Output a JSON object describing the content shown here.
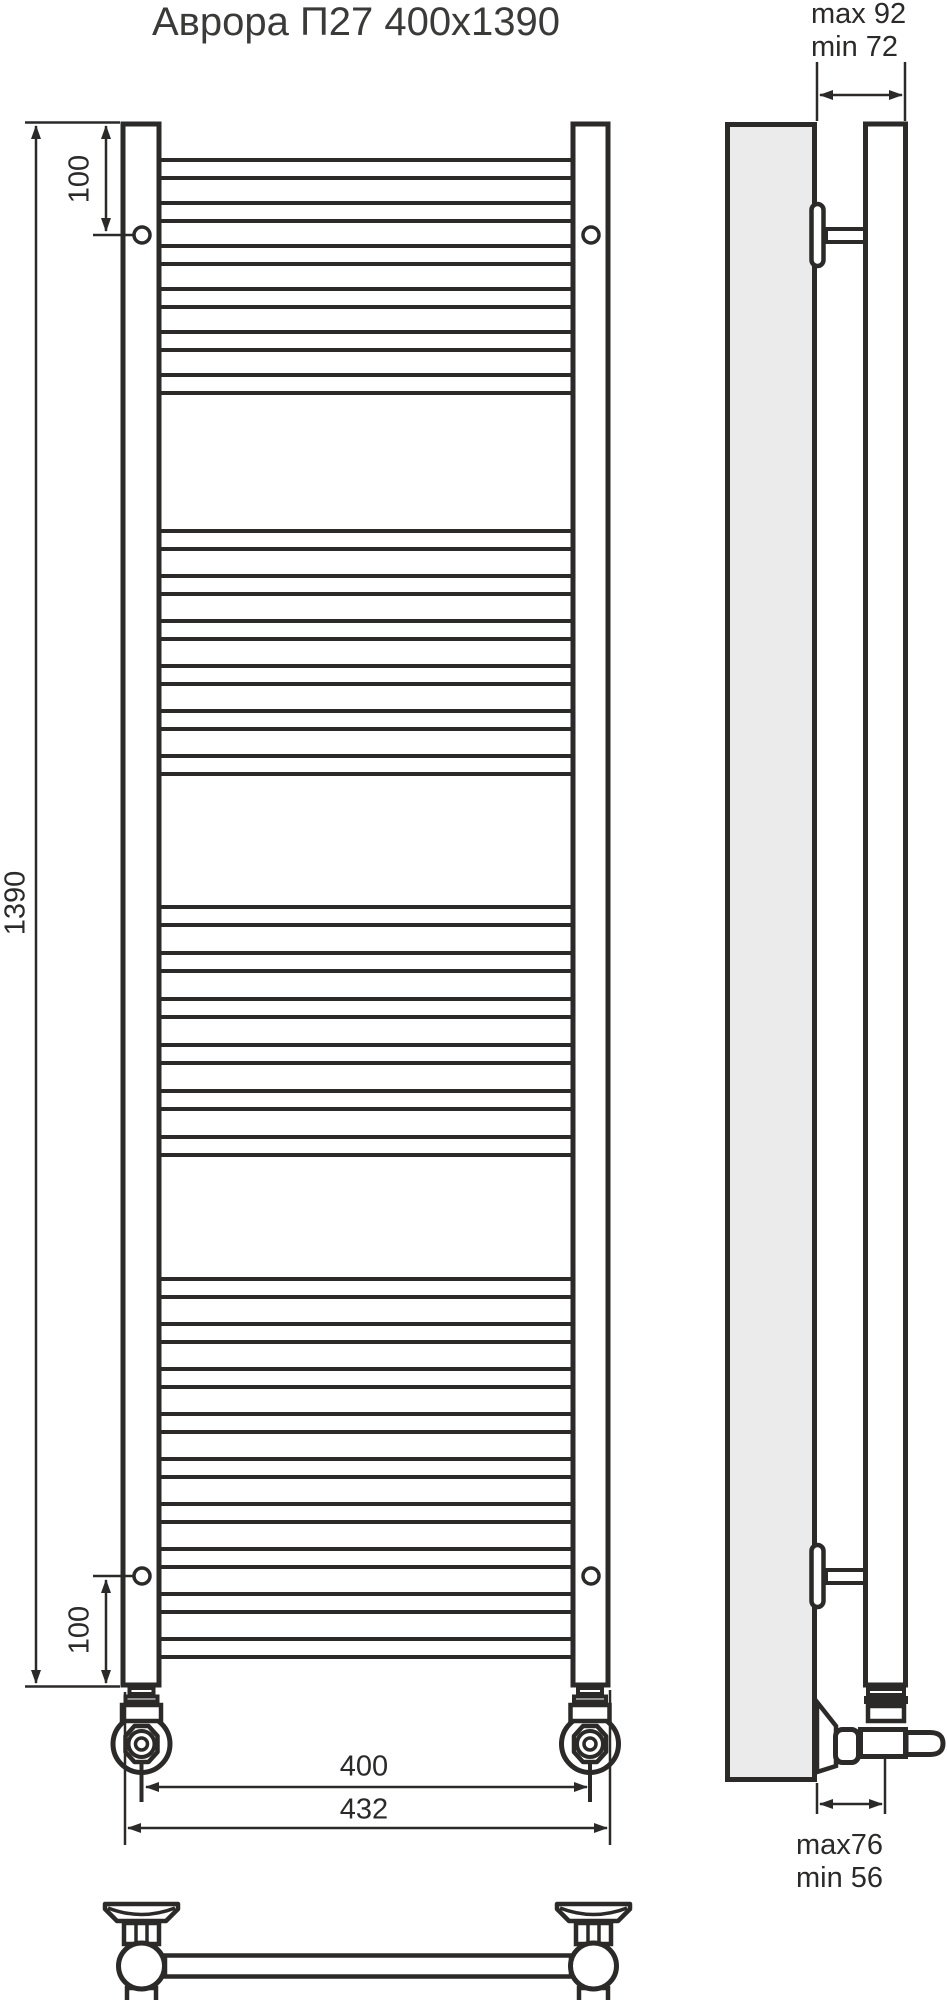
{
  "title": "Аврора П27 400x1390",
  "front_view": {
    "dim_height": "1390",
    "dim_top_offset": "100",
    "dim_bottom_offset": "100",
    "dim_axle_width": "400",
    "dim_overall_width": "432",
    "rungs_total": 27,
    "rung_groups": [
      6,
      6,
      6,
      9
    ]
  },
  "side_view": {
    "dim_top_depth_max": "max 92",
    "dim_top_depth_min": "min 72",
    "dim_bottom_depth_max": "max76",
    "dim_bottom_depth_min": "min 56"
  },
  "colors": {
    "line": "#2b2a29",
    "text": "#3a3a38",
    "wall_fill": "#ebebeb",
    "bg": "#ffffff"
  }
}
